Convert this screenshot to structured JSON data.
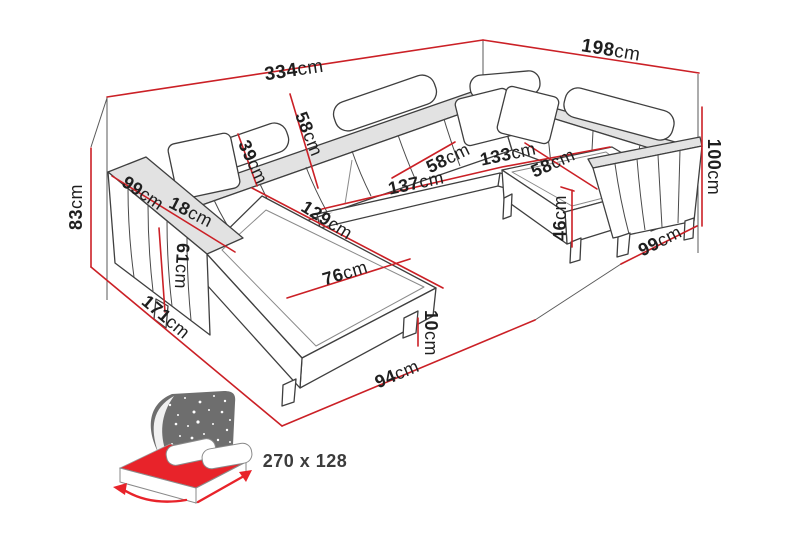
{
  "diagram_title": "corner-sofa-dimensions",
  "unit": "cm",
  "colors": {
    "background": "#ffffff",
    "dimension_red": "#cb2026",
    "outline_dark": "#3f3f3f",
    "frame_gray": "#5a5a5a",
    "label_black": "#1f1f1f",
    "bed_red": "#e8232a",
    "headboard_gray": "#6e6e6e",
    "bed_label_gray": "#3c3c3c"
  },
  "dims": {
    "total_width": {
      "value": "334",
      "unit": "cm"
    },
    "total_depth": {
      "value": "198",
      "unit": "cm"
    },
    "back_height": {
      "value": "100",
      "unit": "cm"
    },
    "seat_width_right": {
      "value": "99",
      "unit": "cm"
    },
    "seat_height": {
      "value": "46",
      "unit": "cm"
    },
    "left_height": {
      "value": "83",
      "unit": "cm"
    },
    "left_side_depth": {
      "value": "171",
      "unit": "cm"
    },
    "front_width": {
      "value": "94",
      "unit": "cm"
    },
    "leg_height": {
      "value": "10",
      "unit": "cm"
    },
    "headrest_depth": {
      "value": "39",
      "unit": "cm"
    },
    "backrest_depth": {
      "value": "58",
      "unit": "cm"
    },
    "armrest_length": {
      "value": "99",
      "unit": "cm"
    },
    "armrest_width": {
      "value": "18",
      "unit": "cm"
    },
    "armrest_height": {
      "value": "61",
      "unit": "cm"
    },
    "chaise_length": {
      "value": "129",
      "unit": "cm"
    },
    "inner_seat_length": {
      "value": "137",
      "unit": "cm"
    },
    "seat_depth_left": {
      "value": "58",
      "unit": "cm"
    },
    "corner_width": {
      "value": "133",
      "unit": "cm"
    },
    "seat_depth_right": {
      "value": "58",
      "unit": "cm"
    },
    "chaise_width": {
      "value": "76",
      "unit": "cm"
    }
  },
  "sleeping_area": {
    "size_label": "270 x 128"
  }
}
